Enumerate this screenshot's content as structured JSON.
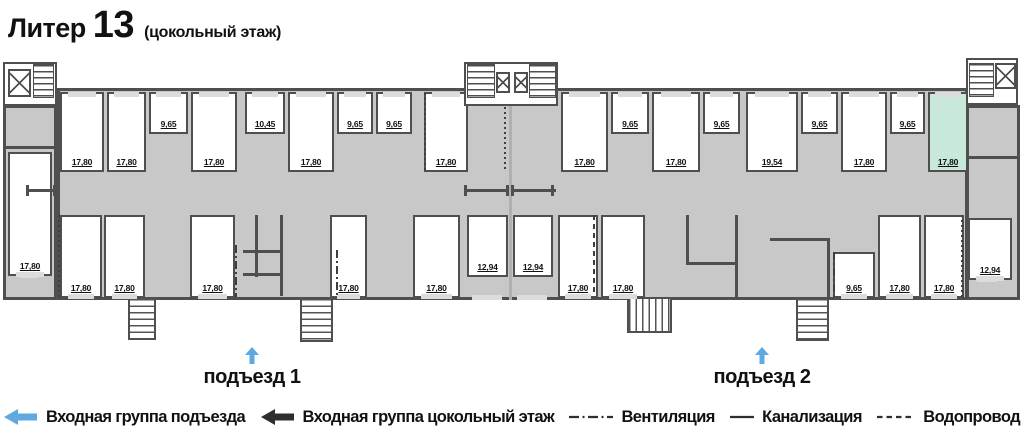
{
  "title": {
    "prefix": "Литер",
    "number": "13",
    "subtitle": "(цокольный этаж)"
  },
  "entrances": [
    {
      "label": "подъезд 1",
      "cx": 252,
      "arrow_y": 347,
      "text_y": 366
    },
    {
      "label": "подъезд 2",
      "cx": 762,
      "arrow_y": 347,
      "text_y": 366
    }
  ],
  "legend": [
    {
      "glyph": "arrow-blue",
      "label": "Входная группа подъезда"
    },
    {
      "glyph": "arrow-black",
      "label": "Входная группа цокольный этаж"
    },
    {
      "glyph": "line-dashdot",
      "label": "Вентиляция"
    },
    {
      "glyph": "line-solid",
      "label": "Канализация"
    },
    {
      "glyph": "line-dashed",
      "label": "Водопровод"
    }
  ],
  "colors": {
    "wall": "#4f4f4f",
    "floor": "#c8c8c8",
    "window_gap": "#dcdcdc",
    "highlight": "#c8e9d9",
    "arrow_blue": "#5fa8e0",
    "arrow_black": "#2e2e2e",
    "text": "#111111"
  },
  "rooms": [
    {
      "label": "17,80",
      "x": 60,
      "y": 92,
      "w": 44,
      "h": 80,
      "win": "top"
    },
    {
      "label": "17,80",
      "x": 107,
      "y": 92,
      "w": 39,
      "h": 80,
      "win": "top"
    },
    {
      "label": "9,65",
      "x": 149,
      "y": 92,
      "w": 39,
      "h": 42,
      "win": "top"
    },
    {
      "label": "17,80",
      "x": 191,
      "y": 92,
      "w": 46,
      "h": 80,
      "win": "top"
    },
    {
      "label": "10,45",
      "x": 245,
      "y": 92,
      "w": 40,
      "h": 42,
      "win": "top"
    },
    {
      "label": "17,80",
      "x": 288,
      "y": 92,
      "w": 46,
      "h": 80,
      "win": "top"
    },
    {
      "label": "9,65",
      "x": 337,
      "y": 92,
      "w": 36,
      "h": 42,
      "win": "top"
    },
    {
      "label": "9,65",
      "x": 376,
      "y": 92,
      "w": 36,
      "h": 42,
      "win": "top"
    },
    {
      "label": "17,80",
      "x": 424,
      "y": 92,
      "w": 44,
      "h": 80,
      "win": "top"
    },
    {
      "label": "17,80",
      "x": 561,
      "y": 92,
      "w": 47,
      "h": 80,
      "win": "top"
    },
    {
      "label": "9,65",
      "x": 611,
      "y": 92,
      "w": 38,
      "h": 42,
      "win": "top"
    },
    {
      "label": "17,80",
      "x": 652,
      "y": 92,
      "w": 48,
      "h": 80,
      "win": "top"
    },
    {
      "label": "9,65",
      "x": 703,
      "y": 92,
      "w": 37,
      "h": 42,
      "win": "top"
    },
    {
      "label": "19,54",
      "x": 746,
      "y": 92,
      "w": 52,
      "h": 80,
      "win": "top"
    },
    {
      "label": "9,65",
      "x": 801,
      "y": 92,
      "w": 37,
      "h": 42,
      "win": "top"
    },
    {
      "label": "17,80",
      "x": 841,
      "y": 92,
      "w": 46,
      "h": 80,
      "win": "top"
    },
    {
      "label": "9,65",
      "x": 890,
      "y": 92,
      "w": 35,
      "h": 42,
      "win": "top"
    },
    {
      "label": "17,80",
      "x": 928,
      "y": 92,
      "w": 40,
      "h": 80,
      "win": "top",
      "highlighted": true
    },
    {
      "label": "17,80",
      "x": 8,
      "y": 152,
      "w": 44,
      "h": 124,
      "win": "bottom"
    },
    {
      "label": "17,80",
      "x": 60,
      "y": 215,
      "w": 42,
      "h": 83,
      "win": "bottom"
    },
    {
      "label": "17,80",
      "x": 104,
      "y": 215,
      "w": 41,
      "h": 83,
      "win": "bottom"
    },
    {
      "label": "17,80",
      "x": 190,
      "y": 215,
      "w": 45,
      "h": 83,
      "win": "bottom"
    },
    {
      "label": "17,80",
      "x": 330,
      "y": 215,
      "w": 37,
      "h": 83,
      "win": "bottom"
    },
    {
      "label": "17,80",
      "x": 413,
      "y": 215,
      "w": 47,
      "h": 83,
      "win": "bottom"
    },
    {
      "label": "12,94",
      "x": 467,
      "y": 215,
      "w": 41,
      "h": 62,
      "win": null
    },
    {
      "label": "12,94",
      "x": 513,
      "y": 215,
      "w": 40,
      "h": 62,
      "win": null
    },
    {
      "label": "17,80",
      "x": 558,
      "y": 215,
      "w": 40,
      "h": 83,
      "win": "bottom"
    },
    {
      "label": "17,80",
      "x": 601,
      "y": 215,
      "w": 44,
      "h": 83,
      "win": "bottom"
    },
    {
      "label": "9,65",
      "x": 833,
      "y": 252,
      "w": 42,
      "h": 46,
      "win": "bottom"
    },
    {
      "label": "17,80",
      "x": 878,
      "y": 215,
      "w": 43,
      "h": 83,
      "win": "bottom"
    },
    {
      "label": "17,80",
      "x": 924,
      "y": 215,
      "w": 40,
      "h": 83,
      "win": "bottom"
    },
    {
      "label": "12,94",
      "x": 968,
      "y": 218,
      "w": 44,
      "h": 62,
      "win": "bottom"
    }
  ],
  "plan": {
    "walls": [
      {
        "x": 3,
        "y": 146,
        "w": 54,
        "h": 3
      },
      {
        "x": 968,
        "y": 156,
        "w": 50,
        "h": 3
      },
      {
        "x": 28,
        "y": 189,
        "w": 28,
        "h": 3
      },
      {
        "x": 26,
        "y": 185,
        "w": 3,
        "h": 11
      },
      {
        "x": 53,
        "y": 185,
        "w": 3,
        "h": 11
      },
      {
        "x": 466,
        "y": 189,
        "w": 43,
        "h": 3
      },
      {
        "x": 464,
        "y": 185,
        "w": 3,
        "h": 11
      },
      {
        "x": 506,
        "y": 185,
        "w": 3,
        "h": 11
      },
      {
        "x": 513,
        "y": 189,
        "w": 43,
        "h": 3
      },
      {
        "x": 511,
        "y": 185,
        "w": 3,
        "h": 11
      },
      {
        "x": 551,
        "y": 185,
        "w": 3,
        "h": 11
      },
      {
        "x": 255,
        "y": 215,
        "w": 3,
        "h": 62
      },
      {
        "x": 280,
        "y": 215,
        "w": 3,
        "h": 81
      },
      {
        "x": 243,
        "y": 250,
        "w": 40,
        "h": 3
      },
      {
        "x": 243,
        "y": 273,
        "w": 40,
        "h": 3
      },
      {
        "x": 686,
        "y": 215,
        "w": 3,
        "h": 50
      },
      {
        "x": 686,
        "y": 262,
        "w": 52,
        "h": 3
      },
      {
        "x": 735,
        "y": 215,
        "w": 3,
        "h": 83
      },
      {
        "x": 770,
        "y": 238,
        "w": 60,
        "h": 3
      },
      {
        "x": 827,
        "y": 238,
        "w": 3,
        "h": 60
      }
    ],
    "door_gaps": [
      {
        "x": 472,
        "y": 295,
        "w": 30,
        "h": 5
      },
      {
        "x": 517,
        "y": 295,
        "w": 30,
        "h": 5
      },
      {
        "x": 20,
        "y": 273,
        "w": 18,
        "h": 5
      },
      {
        "x": 977,
        "y": 277,
        "w": 20,
        "h": 5
      }
    ],
    "utilities": [
      {
        "style": "dotted",
        "x": 58,
        "y": 215,
        "h": 82
      },
      {
        "style": "dotted",
        "x": 424,
        "y": 93,
        "h": 78
      },
      {
        "style": "dashdot",
        "x": 235,
        "y": 245,
        "h": 52
      },
      {
        "style": "dashdot",
        "x": 336,
        "y": 250,
        "h": 47
      },
      {
        "style": "dotted",
        "x": 504,
        "y": 92,
        "h": 79
      },
      {
        "style": "dashed",
        "x": 593,
        "y": 215,
        "h": 81
      },
      {
        "style": "dashdot",
        "x": 833,
        "y": 252,
        "h": 46
      },
      {
        "style": "dotted",
        "x": 961,
        "y": 215,
        "h": 82
      }
    ],
    "cores": [
      {
        "box": {
          "x": 3,
          "y": 62,
          "w": 54,
          "h": 44
        },
        "elevators": [
          {
            "x": 8,
            "y": 69,
            "w": 23,
            "h": 28
          }
        ],
        "stairs": [
          {
            "x": 33,
            "y": 64,
            "w": 21,
            "h": 34,
            "dir": "v"
          }
        ]
      },
      {
        "box": {
          "x": 464,
          "y": 62,
          "w": 94,
          "h": 44
        },
        "elevators": [
          {
            "x": 496,
            "y": 72,
            "w": 14,
            "h": 21
          },
          {
            "x": 514,
            "y": 72,
            "w": 14,
            "h": 21
          }
        ],
        "stairs": [
          {
            "x": 467,
            "y": 64,
            "w": 28,
            "h": 34,
            "dir": "v"
          },
          {
            "x": 529,
            "y": 64,
            "w": 27,
            "h": 34,
            "dir": "v"
          }
        ]
      },
      {
        "box": {
          "x": 966,
          "y": 58,
          "w": 52,
          "h": 47
        },
        "elevators": [
          {
            "x": 995,
            "y": 63,
            "w": 21,
            "h": 26
          }
        ],
        "stairs": [
          {
            "x": 969,
            "y": 63,
            "w": 25,
            "h": 34,
            "dir": "v"
          }
        ]
      }
    ],
    "external_stairs": [
      {
        "x": 128,
        "y": 299,
        "w": 28,
        "h": 41,
        "dir": "v"
      },
      {
        "x": 300,
        "y": 299,
        "w": 33,
        "h": 43,
        "dir": "v"
      },
      {
        "x": 627,
        "y": 299,
        "w": 45,
        "h": 34,
        "dir": "h"
      },
      {
        "x": 796,
        "y": 299,
        "w": 33,
        "h": 42,
        "dir": "v"
      }
    ]
  }
}
